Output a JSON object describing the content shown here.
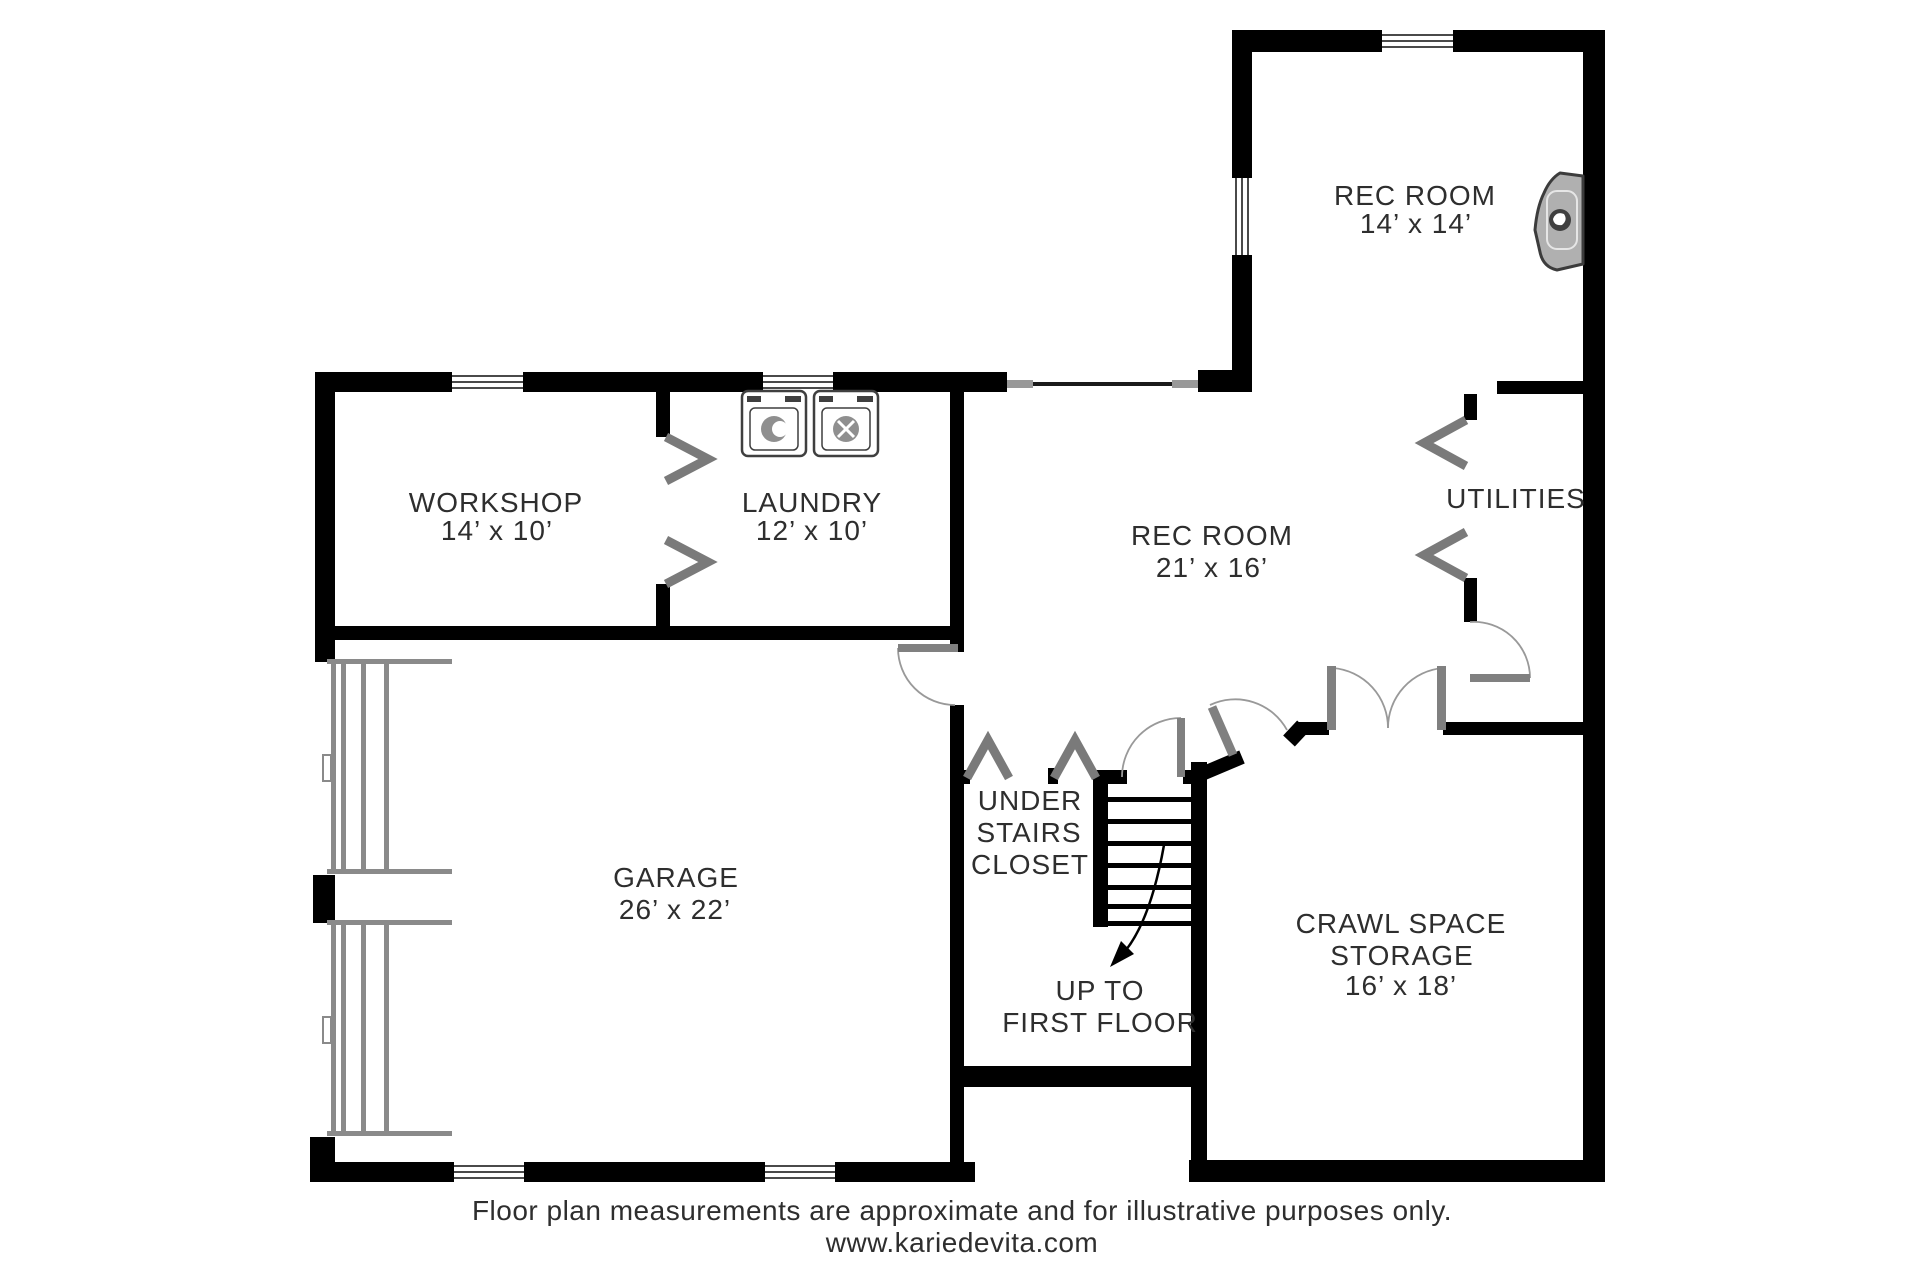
{
  "plan": {
    "rooms": {
      "rec_room_upper": {
        "name": "REC ROOM",
        "dims": "14’ x 14’"
      },
      "rec_room_main": {
        "name": "REC ROOM",
        "dims": "21’ x 16’"
      },
      "workshop": {
        "name": "WORKSHOP",
        "dims": "14’ x 10’"
      },
      "laundry": {
        "name": "LAUNDRY",
        "dims": "12’ x 10’"
      },
      "utilities": {
        "name": "UTILITIES"
      },
      "garage": {
        "name": "GARAGE",
        "dims": "26’ x 22’"
      },
      "under_stairs_closet": {
        "line1": "UNDER",
        "line2": "STAIRS",
        "line3": "CLOSET"
      },
      "stairs": {
        "line1": "UP TO",
        "line2": "FIRST FLOOR"
      },
      "crawl_space": {
        "line1": "CRAWL SPACE",
        "line2": "STORAGE",
        "dims": "16’ x 18’"
      }
    },
    "footer": {
      "line1": "Floor plan measurements are approximate and for illustrative purposes only.",
      "line2": "www.kariedevita.com"
    },
    "colors": {
      "wall": "#000000",
      "door_leaf": "#808080",
      "swing_arc": "#999999",
      "chevron": "#7a7a7a",
      "fixture_outline": "#3f3f3f",
      "fixture_fill": "#8f8f8f",
      "text": "#2e2e2e"
    },
    "icons": [
      "washer-icon",
      "dryer-icon",
      "wall-fireplace-icon",
      "garage-door-icon",
      "stairs-up-arrow-icon"
    ]
  }
}
